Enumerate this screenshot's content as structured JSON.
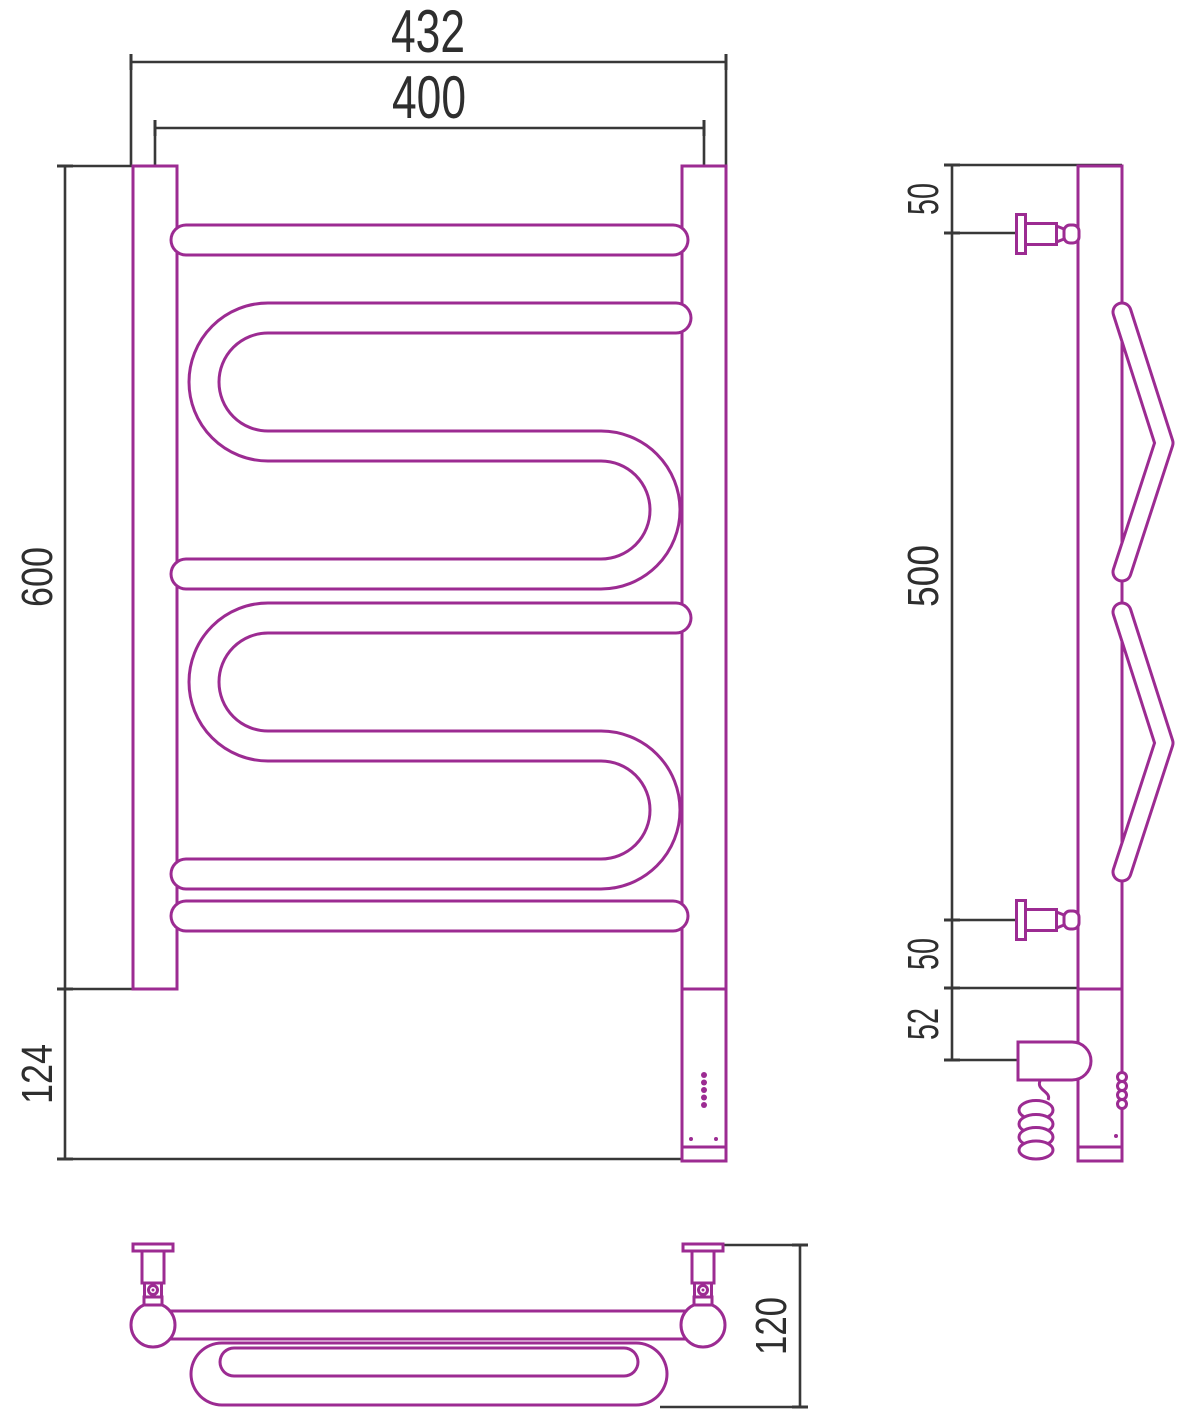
{
  "title": "Electric towel rail technical drawing, three orthographic views",
  "colors": {
    "line": "#9C2B92",
    "dim": "#383838",
    "bg": "#ffffff"
  },
  "front_view": {
    "dim_width_outer": "432",
    "dim_width_centers": "400",
    "dim_height": "600",
    "dim_bottom_height": "124"
  },
  "side_view": {
    "dim_top_offset": "50",
    "dim_bracket_spacing": "500",
    "dim_bottom_offset": "50",
    "dim_unit_offset": "52"
  },
  "top_view": {
    "dim_depth": "120"
  }
}
